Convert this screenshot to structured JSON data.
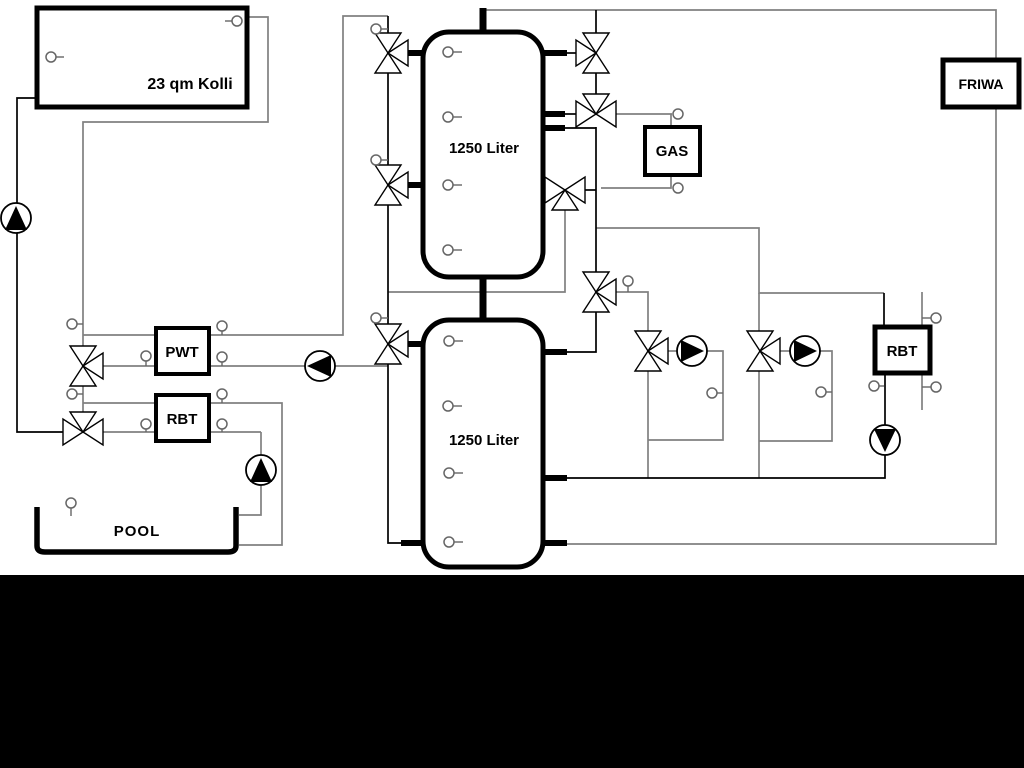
{
  "diagram_type": "hydraulic-heating-scheme",
  "labels": {
    "collector": "23 qm Kolli",
    "tank_top": "1250 Liter",
    "tank_bottom": "1250 Liter",
    "gas": "GAS",
    "friwa": "FRIWA",
    "pwt": "PWT",
    "rbt_pool": "RBT",
    "rbt_right": "RBT",
    "pool": "POOL"
  },
  "colors": {
    "background": "#ffffff",
    "footer_band": "#000000",
    "pipe_gray": "#808080",
    "pipe_black": "#000000",
    "component_stroke": "#000000"
  },
  "components": {
    "tanks": 2,
    "pumps": 6,
    "three_way_valves": 11,
    "temperature_sensors": 25
  }
}
